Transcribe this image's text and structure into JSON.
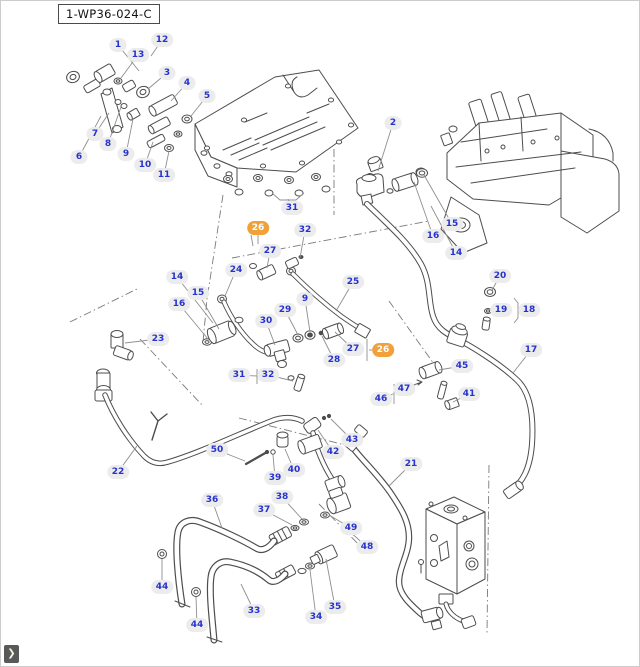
{
  "page": {
    "width": 640,
    "height": 667,
    "background": "#ffffff",
    "border": "#cccccc"
  },
  "header": {
    "diagram_code": "1-WP36-024-C"
  },
  "nav": {
    "next_glyph": "❯"
  },
  "colors": {
    "callout_text": "#2633cc",
    "callout_bg": "#ececec",
    "highlight_bg": "#f0a13a",
    "highlight_text": "#ffffff",
    "leader": "#8f8f8f",
    "line_art": "#4d4d4d",
    "nav_bg": "#595959",
    "nav_glyph": "#f8f3e6"
  },
  "callouts": [
    {
      "label": "1",
      "x": 117,
      "y": 44,
      "tx": 138,
      "ty": 70,
      "highlight": false
    },
    {
      "label": "12",
      "x": 161,
      "y": 39,
      "tx": 150,
      "ty": 55,
      "highlight": false
    },
    {
      "label": "13",
      "x": 137,
      "y": 54,
      "tx": 120,
      "ty": 77,
      "highlight": false
    },
    {
      "label": "3",
      "x": 166,
      "y": 72,
      "tx": 147,
      "ty": 88,
      "highlight": false
    },
    {
      "label": "4",
      "x": 186,
      "y": 82,
      "tx": 170,
      "ty": 100,
      "highlight": false
    },
    {
      "label": "5",
      "x": 206,
      "y": 95,
      "tx": 190,
      "ty": 115,
      "highlight": false
    },
    {
      "label": "7",
      "x": 94,
      "y": 133,
      "tx": 108,
      "ty": 112,
      "highlight": false
    },
    {
      "label": "8",
      "x": 107,
      "y": 143,
      "tx": 120,
      "ty": 106,
      "highlight": false
    },
    {
      "label": "6",
      "x": 78,
      "y": 156,
      "tx": 100,
      "ty": 115,
      "highlight": false
    },
    {
      "label": "9",
      "x": 125,
      "y": 153,
      "tx": 132,
      "ty": 118,
      "highlight": false
    },
    {
      "label": "10",
      "x": 144,
      "y": 164,
      "tx": 152,
      "ty": 141,
      "highlight": false
    },
    {
      "label": "11",
      "x": 163,
      "y": 174,
      "tx": 168,
      "ty": 150,
      "highlight": false
    },
    {
      "label": "2",
      "x": 392,
      "y": 122,
      "tx": 377,
      "ty": 170,
      "highlight": false
    },
    {
      "label": "31",
      "x": 291,
      "y": 207,
      "tx": 287,
      "ty": 198,
      "highlight": false
    },
    {
      "label": "26",
      "x": 257,
      "y": 227,
      "tx": 257,
      "ty": 243,
      "highlight": true
    },
    {
      "label": "32",
      "x": 304,
      "y": 229,
      "tx": 299,
      "ty": 257,
      "highlight": false
    },
    {
      "label": "27",
      "x": 269,
      "y": 250,
      "tx": 266,
      "ty": 267,
      "highlight": false
    },
    {
      "label": "24",
      "x": 235,
      "y": 269,
      "tx": 224,
      "ty": 295,
      "highlight": false
    },
    {
      "label": "25",
      "x": 352,
      "y": 281,
      "tx": 335,
      "ty": 310,
      "highlight": false
    },
    {
      "label": "15",
      "x": 451,
      "y": 223,
      "tx": 423,
      "ty": 174,
      "highlight": false
    },
    {
      "label": "16",
      "x": 432,
      "y": 235,
      "tx": 413,
      "ty": 181,
      "highlight": false
    },
    {
      "label": "14",
      "x": 455,
      "y": 252,
      "tx": 430,
      "ty": 205,
      "highlight": false
    },
    {
      "label": "20",
      "x": 499,
      "y": 275,
      "tx": 491,
      "ty": 289,
      "highlight": false
    },
    {
      "label": "19",
      "x": 500,
      "y": 309,
      "tx": 490,
      "ty": 310,
      "highlight": false
    },
    {
      "label": "18",
      "x": 528,
      "y": 309,
      "tx": 518,
      "ty": 309,
      "highlight": false
    },
    {
      "label": "17",
      "x": 530,
      "y": 349,
      "tx": 512,
      "ty": 372,
      "highlight": false
    },
    {
      "label": "45",
      "x": 461,
      "y": 365,
      "tx": 438,
      "ty": 369,
      "highlight": false
    },
    {
      "label": "47",
      "x": 403,
      "y": 388,
      "tx": 416,
      "ty": 383,
      "highlight": false
    },
    {
      "label": "46",
      "x": 380,
      "y": 398,
      "tx": 392,
      "ty": 393,
      "highlight": false
    },
    {
      "label": "41",
      "x": 468,
      "y": 393,
      "tx": 452,
      "ty": 401,
      "highlight": false
    },
    {
      "label": "14",
      "x": 176,
      "y": 276,
      "tx": 212,
      "ty": 322,
      "highlight": false
    },
    {
      "label": "15",
      "x": 197,
      "y": 292,
      "tx": 218,
      "ty": 328,
      "highlight": false
    },
    {
      "label": "16",
      "x": 178,
      "y": 303,
      "tx": 207,
      "ty": 338,
      "highlight": false
    },
    {
      "label": "23",
      "x": 157,
      "y": 338,
      "tx": 124,
      "ty": 342,
      "highlight": false
    },
    {
      "label": "9",
      "x": 304,
      "y": 298,
      "tx": 309,
      "ty": 331,
      "highlight": false
    },
    {
      "label": "29",
      "x": 284,
      "y": 309,
      "tx": 297,
      "ty": 334,
      "highlight": false
    },
    {
      "label": "30",
      "x": 265,
      "y": 320,
      "tx": 274,
      "ty": 344,
      "highlight": false
    },
    {
      "label": "27",
      "x": 352,
      "y": 348,
      "tx": 334,
      "ty": 331,
      "highlight": false
    },
    {
      "label": "26",
      "x": 382,
      "y": 349,
      "tx": 368,
      "ty": 349,
      "highlight": true
    },
    {
      "label": "28",
      "x": 333,
      "y": 359,
      "tx": 321,
      "ty": 335,
      "highlight": false
    },
    {
      "label": "31",
      "x": 238,
      "y": 374,
      "tx": 256,
      "ty": 375,
      "highlight": false
    },
    {
      "label": "32",
      "x": 267,
      "y": 374,
      "tx": 292,
      "ty": 380,
      "highlight": false
    },
    {
      "label": "22",
      "x": 117,
      "y": 471,
      "tx": 136,
      "ty": 445,
      "highlight": false
    },
    {
      "label": "50",
      "x": 216,
      "y": 449,
      "tx": 244,
      "ty": 460,
      "highlight": false
    },
    {
      "label": "39",
      "x": 274,
      "y": 477,
      "tx": 272,
      "ty": 454,
      "highlight": false
    },
    {
      "label": "40",
      "x": 293,
      "y": 469,
      "tx": 284,
      "ty": 448,
      "highlight": false
    },
    {
      "label": "42",
      "x": 332,
      "y": 451,
      "tx": 317,
      "ty": 429,
      "highlight": false
    },
    {
      "label": "43",
      "x": 351,
      "y": 439,
      "tx": 330,
      "ty": 418,
      "highlight": false
    },
    {
      "label": "21",
      "x": 410,
      "y": 463,
      "tx": 388,
      "ty": 485,
      "highlight": false
    },
    {
      "label": "36",
      "x": 211,
      "y": 499,
      "tx": 221,
      "ty": 527,
      "highlight": false
    },
    {
      "label": "38",
      "x": 281,
      "y": 496,
      "tx": 301,
      "ty": 518,
      "highlight": false
    },
    {
      "label": "37",
      "x": 263,
      "y": 509,
      "tx": 291,
      "ty": 524,
      "highlight": false
    },
    {
      "label": "44",
      "x": 161,
      "y": 586,
      "tx": 161,
      "ty": 558,
      "highlight": false
    },
    {
      "label": "44",
      "x": 196,
      "y": 624,
      "tx": 195,
      "ty": 596,
      "highlight": false
    },
    {
      "label": "33",
      "x": 253,
      "y": 610,
      "tx": 240,
      "ty": 583,
      "highlight": false
    },
    {
      "label": "34",
      "x": 315,
      "y": 616,
      "tx": 309,
      "ty": 569,
      "highlight": false
    },
    {
      "label": "35",
      "x": 334,
      "y": 606,
      "tx": 325,
      "ty": 558,
      "highlight": false
    },
    {
      "label": "49",
      "x": 350,
      "y": 527,
      "tx": 328,
      "ty": 514,
      "highlight": false
    },
    {
      "label": "48",
      "x": 366,
      "y": 546,
      "tx": 348,
      "ty": 530,
      "highlight": false
    }
  ]
}
